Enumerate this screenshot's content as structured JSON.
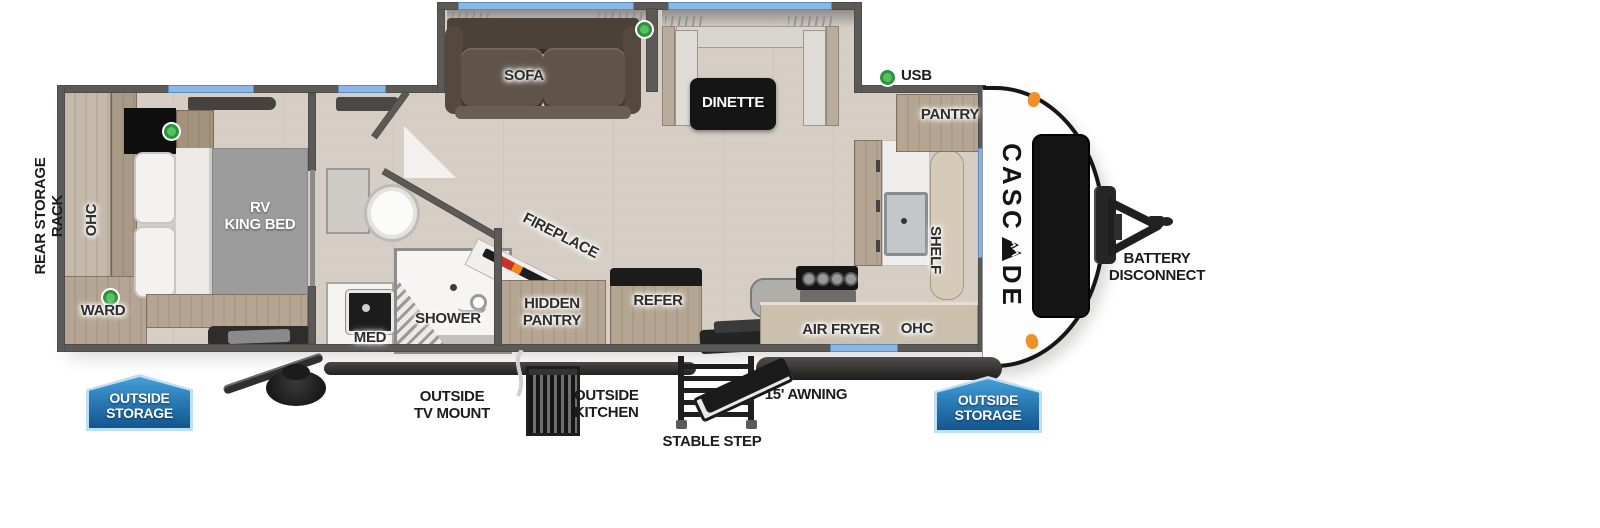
{
  "title": "Cascade travel trailer floor plan",
  "brand": {
    "name_prefix": "CASC",
    "name_suffix": "DE",
    "full_name": "CASCADE"
  },
  "colors": {
    "badge_blue_top": "#45a0d6",
    "badge_blue_bottom": "#14568f",
    "window_blue": "#8ab7e3",
    "usb_green": "#44b24e",
    "wall_gray": "#5c5a57",
    "floor_tan": "#d6cec5",
    "wood_tan": "#b4a692",
    "label_dark": "#2d2d2d"
  },
  "exterior": {
    "rear_storage_rack": "REAR STORAGE RACK",
    "usb": "USB",
    "battery_disconnect": "BATTERY\nDISCONNECT",
    "outside_storage_rear": "OUTSIDE\nSTORAGE",
    "outside_storage_front": "OUTSIDE\nSTORAGE",
    "outside_tv_mount": "OUTSIDE\nTV MOUNT",
    "outside_kitchen": "OUTSIDE\nKITCHEN",
    "stable_step": "STABLE STEP",
    "awning": "15' AWNING"
  },
  "bedroom": {
    "ohc": "OHC",
    "ward": "WARD",
    "bed": "RV\nKING BED"
  },
  "bathroom": {
    "med": "MED",
    "shower": "SHOWER"
  },
  "living": {
    "sofa": "SOFA",
    "dinette": "DINETTE",
    "fireplace": "FIREPLACE",
    "hidden_pantry": "HIDDEN\nPANTRY",
    "refer": "REFER"
  },
  "kitchen": {
    "pantry": "PANTRY",
    "shelf": "SHELF",
    "air_fryer": "AIR FRYER",
    "ohc": "OHC"
  }
}
